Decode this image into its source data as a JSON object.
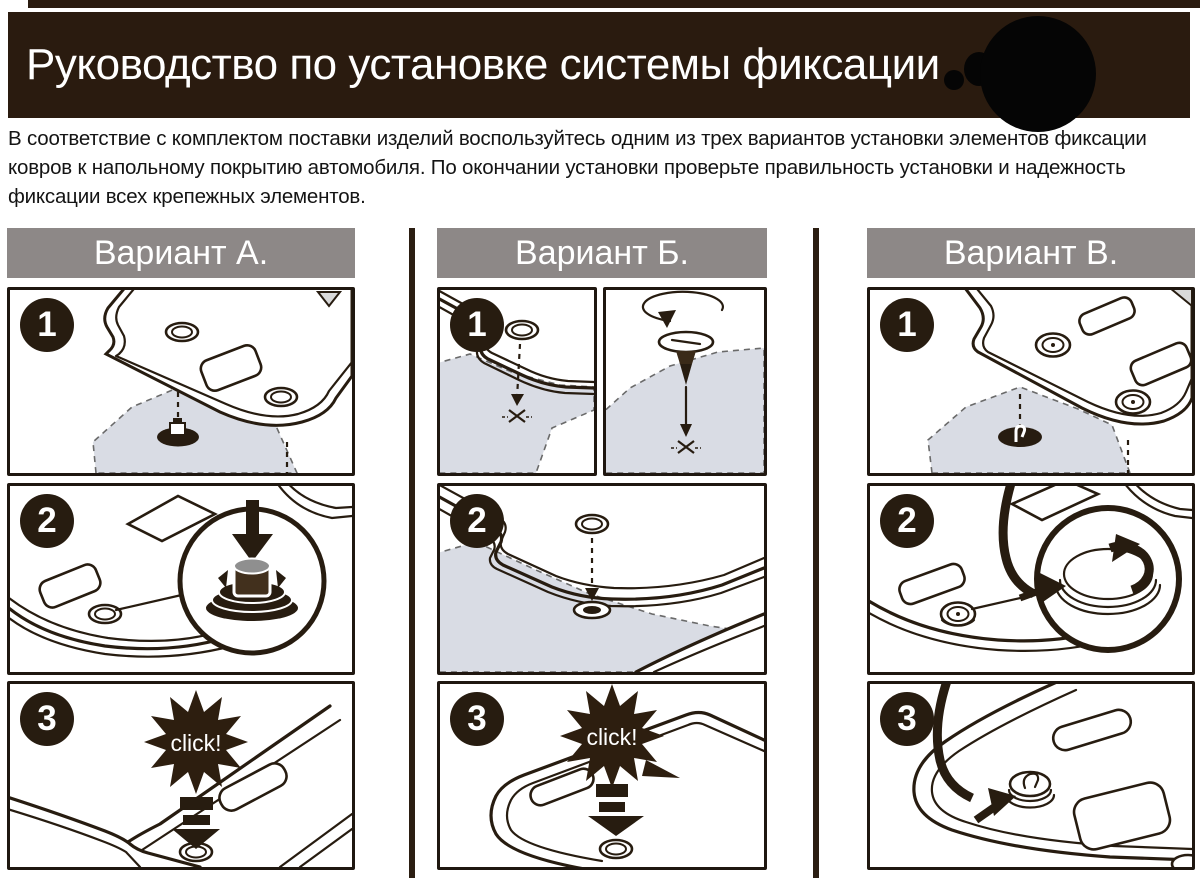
{
  "header": {
    "title": "Руководство по установке системы фиксации",
    "logo": "redacted-round-logo"
  },
  "intro": {
    "text": "В соответствие с комплектом поставки изделий воспользуйтесь одним из трех вариантов установки элементов фиксации\nковров к напольному покрытию автомобиля. По окончании установки проверьте правильность установки и надежность\nфиксации всех крепежных элементов."
  },
  "colors": {
    "header_bg": "#2a1b0f",
    "variant_bar_bg": "#8d8887",
    "carpet": "#d9dce4",
    "ink": "#271c10",
    "burst": "#2d1e0f"
  },
  "icons": {
    "click_burst": "star-burst",
    "press_down": "thick-down-arrow",
    "screw_in": "rotation-arrow",
    "hook_turn": "curved-hook-arrow",
    "target": "x-mark"
  },
  "variants": [
    {
      "label": "Вариант А.",
      "steps": [
        {
          "number": "1"
        },
        {
          "number": "2"
        },
        {
          "number": "3",
          "sound_label": "click!"
        }
      ]
    },
    {
      "label": "Вариант Б.",
      "steps": [
        {
          "number": "1"
        },
        {
          "number": "2"
        },
        {
          "number": "3",
          "sound_label": "click!"
        }
      ]
    },
    {
      "label": "Вариант В.",
      "steps": [
        {
          "number": "1"
        },
        {
          "number": "2"
        },
        {
          "number": "3"
        }
      ]
    }
  ]
}
